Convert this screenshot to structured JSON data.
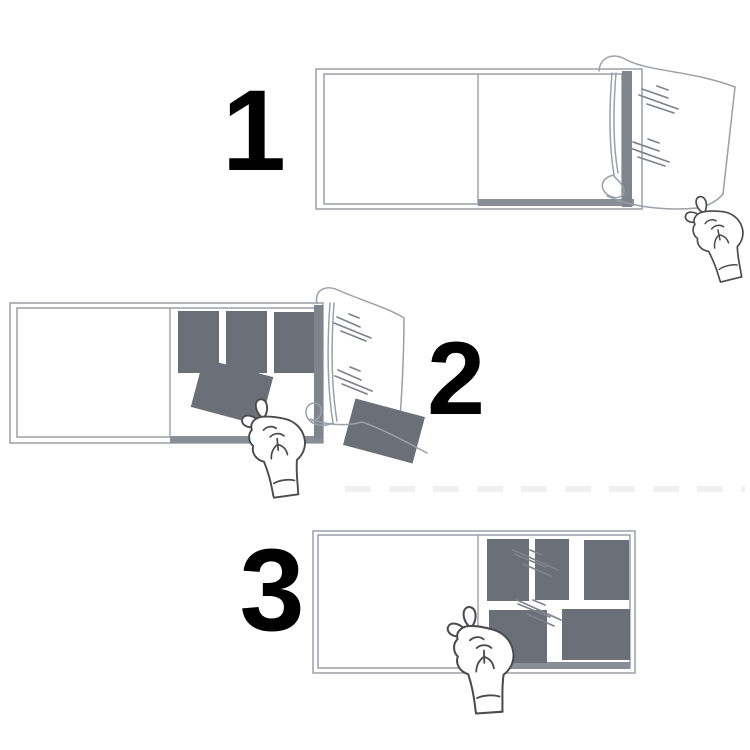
{
  "figure": {
    "type": "instruction-diagram",
    "subject": "photo-album-film-steps",
    "step_count": 3
  },
  "steps": [
    {
      "number": "1"
    },
    {
      "number": "2"
    },
    {
      "number": "3"
    }
  ],
  "colors": {
    "bg": "#ffffff",
    "num": "#000000",
    "photo": "#6b6f77",
    "line": "#9aa0a8",
    "shine": "#7d838c",
    "edge": "#7f848d",
    "bbar": "#8a8f97",
    "hand": "#4b4b4f"
  }
}
